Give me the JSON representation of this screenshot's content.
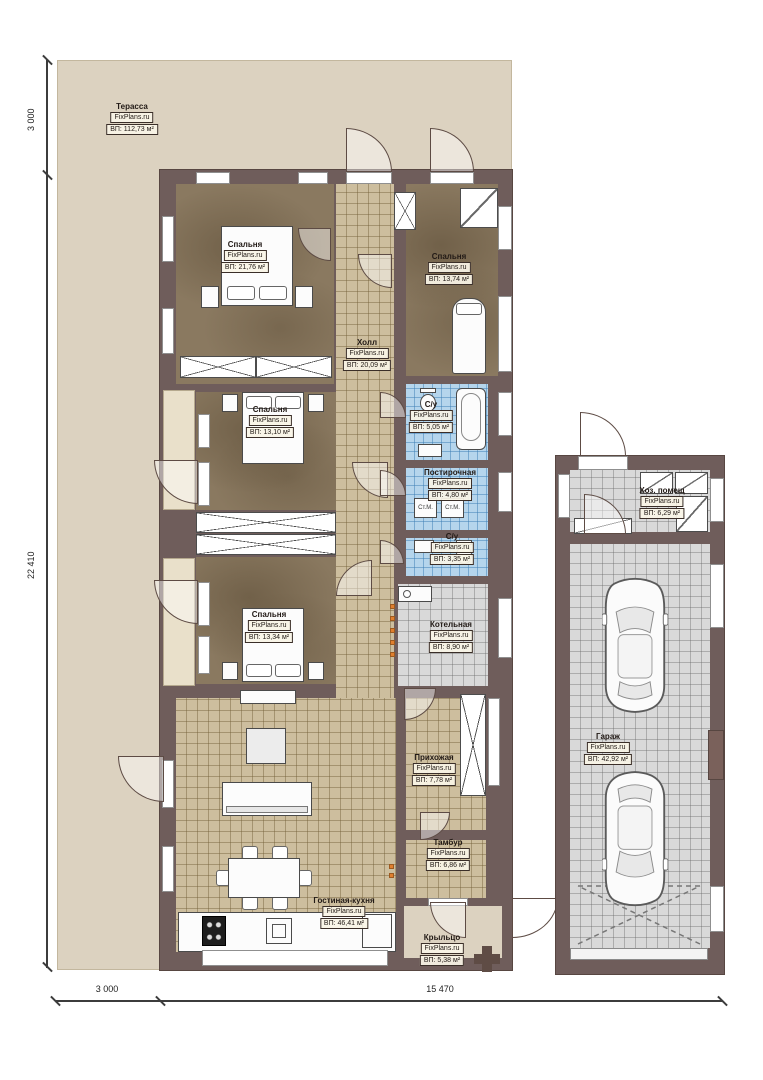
{
  "watermark": "FixPlans.ru",
  "rooms": {
    "terrace": {
      "name": "Терасса",
      "area": "ВП: 112,73 м²"
    },
    "bedroom1": {
      "name": "Спальня",
      "area": "ВП: 21,76 м²"
    },
    "bedroom2": {
      "name": "Спальня",
      "area": "ВП: 13,74 м²"
    },
    "hall": {
      "name": "Холл",
      "area": "ВП: 20,09 м²"
    },
    "bedroom3": {
      "name": "Спальня",
      "area": "ВП: 13,10 м²"
    },
    "bathroom1": {
      "name": "С/у",
      "area": "ВП: 5,05 м²"
    },
    "laundry": {
      "name": "Постирочная",
      "area": "ВП: 4,80 м²"
    },
    "bathroom2": {
      "name": "С/у",
      "area": "ВП: 3,35 м²"
    },
    "bedroom4": {
      "name": "Спальня",
      "area": "ВП: 13,34 м²"
    },
    "boiler": {
      "name": "Котельная",
      "area": "ВП: 8,90 м²"
    },
    "entry": {
      "name": "Прихожая",
      "area": "ВП: 7,78 м²"
    },
    "vestibule": {
      "name": "Тамбур",
      "area": "ВП: 6,86 м²"
    },
    "living_kitchen": {
      "name": "Гостиная-кухня",
      "area": "ВП: 46,41 м²"
    },
    "porch": {
      "name": "Крыльцо",
      "area": "ВП: 5,38 м²"
    },
    "utility": {
      "name": "Хоз. помещ",
      "area": "ВП: 6,29 м²"
    },
    "garage": {
      "name": "Гараж",
      "area": "ВП: 42,92 м²"
    }
  },
  "appliances": {
    "washer_left": "Ст.М.",
    "washer_right": "Ст.М."
  },
  "dimensions": {
    "left_top": "3 000",
    "left_side": "22 410",
    "bottom_left": "3 000",
    "bottom_main": "15 470"
  },
  "colors": {
    "wall": "#6f5d5b",
    "terrace": "#dcd2c0",
    "bedroom_floor": "#8a7960",
    "tile_tan": "#cdbe9e",
    "tile_blue": "#b5d5ec",
    "tile_gray": "#d9d9d9",
    "accent_orange": "#e07f2e"
  }
}
